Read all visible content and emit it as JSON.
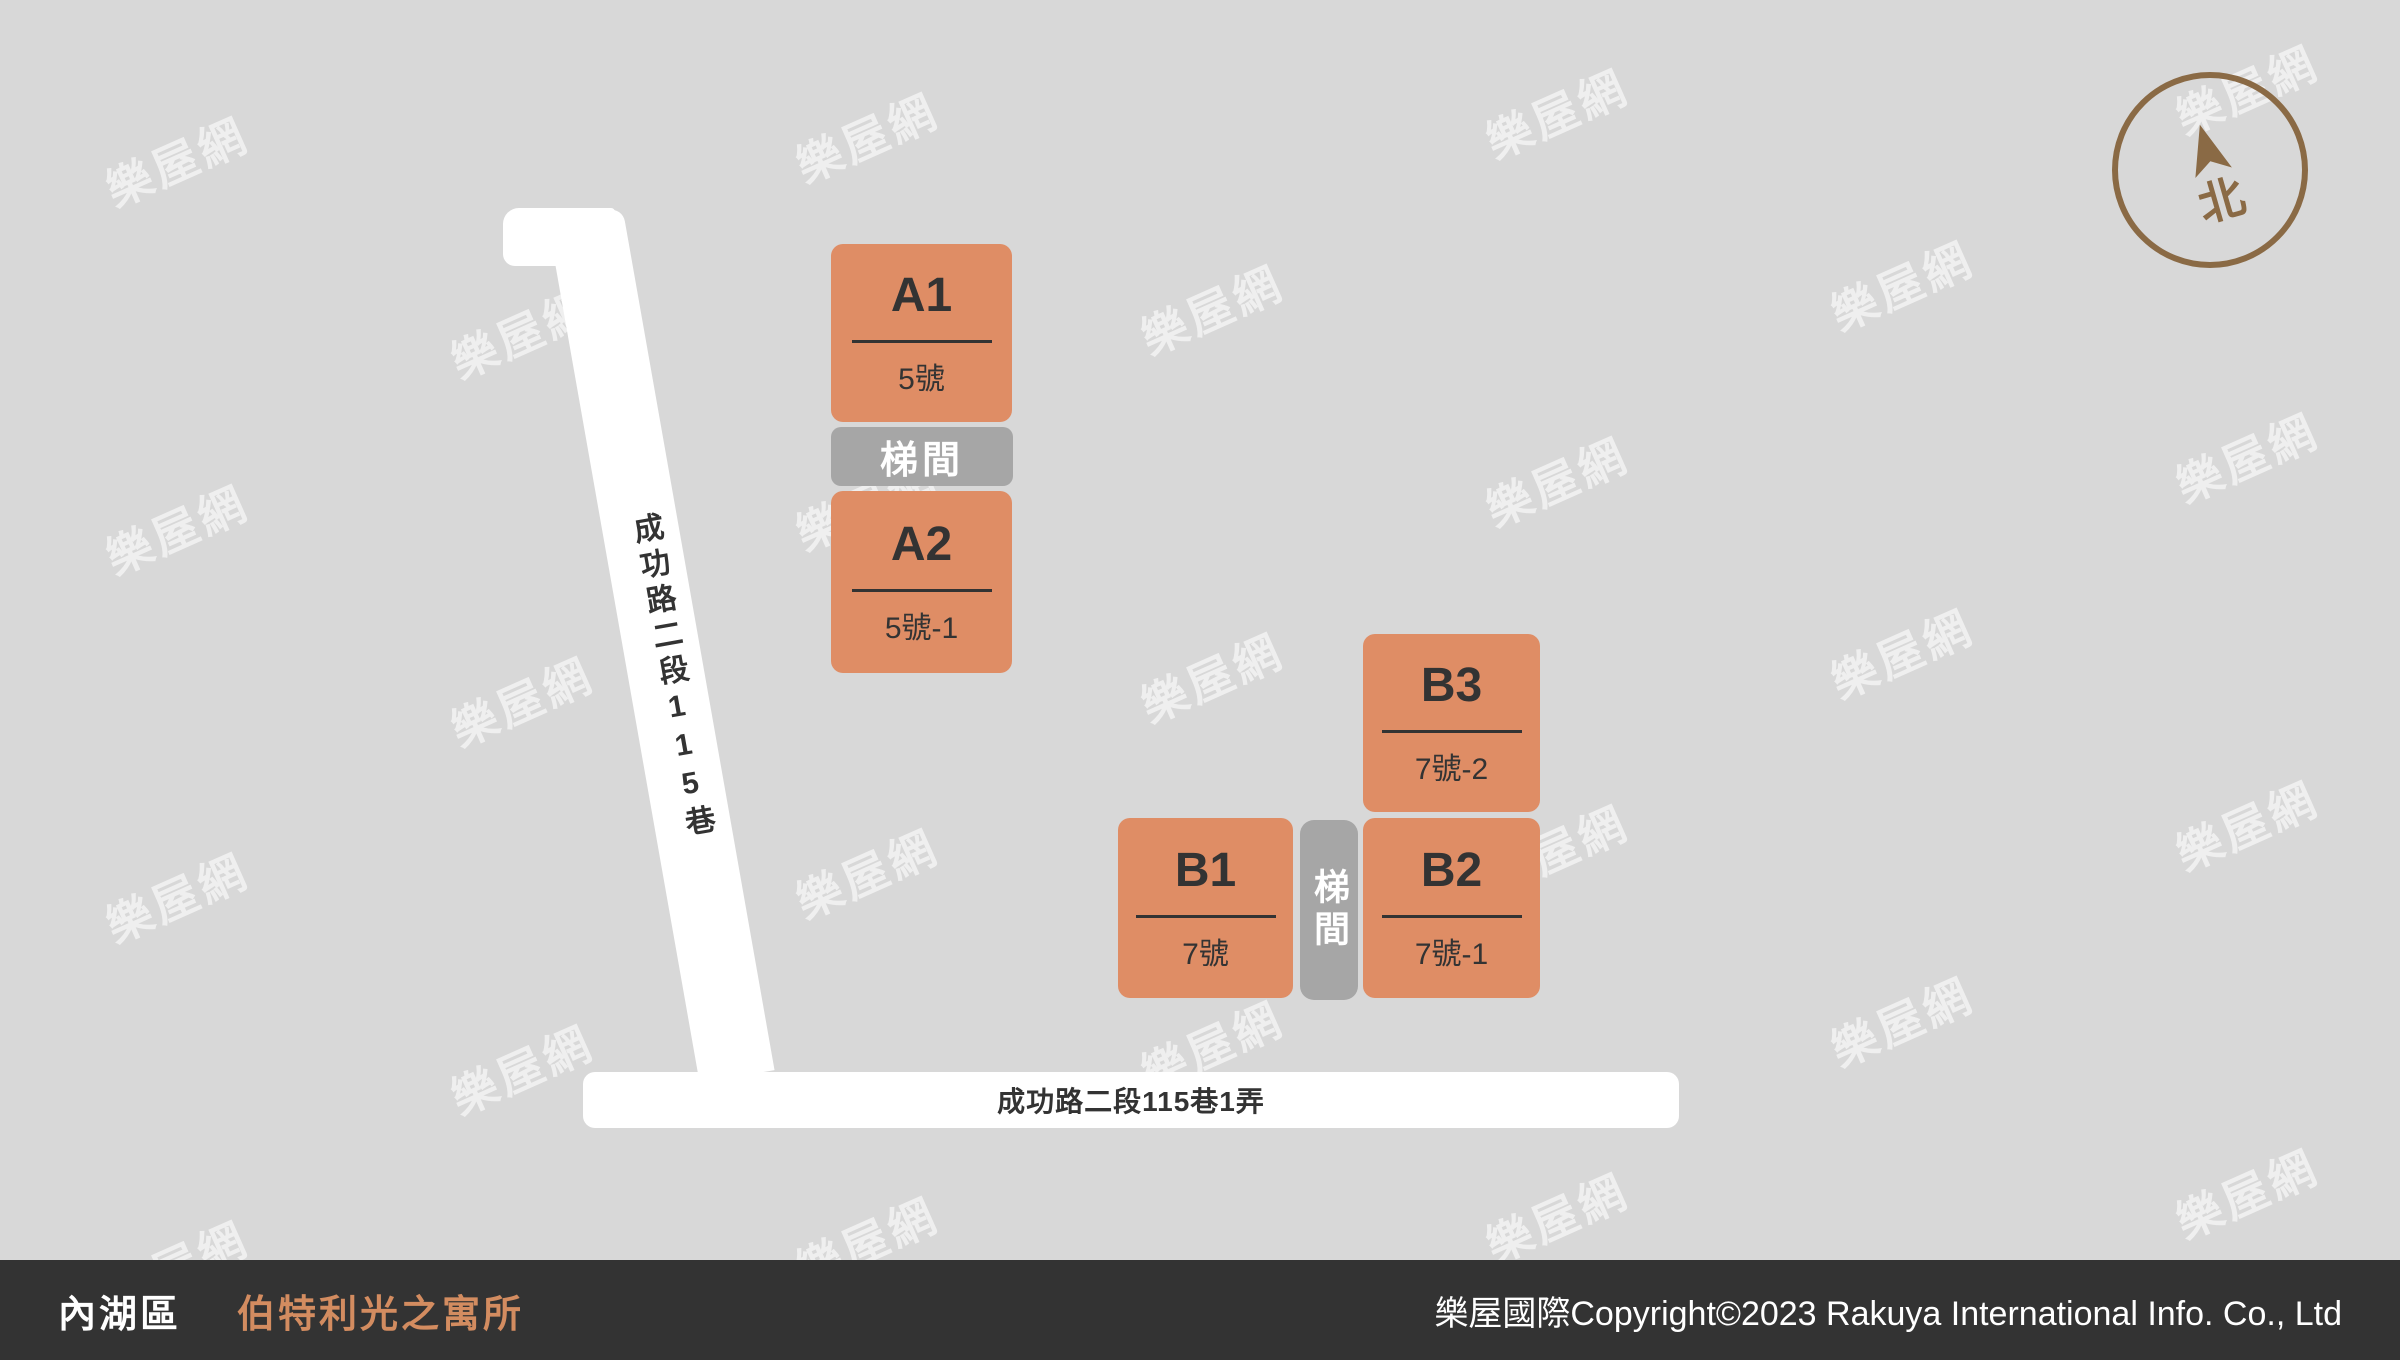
{
  "colors": {
    "bg": "#d8d8d8",
    "block": "#df8d65",
    "block_text": "#333333",
    "stair": "#a6a6a6",
    "road": "#ffffff",
    "footer_bg": "#333333",
    "footer_text": "#ffffff",
    "building_name": "#d38c60",
    "compass": "#8a6a45",
    "watermark": "rgba(255,255,255,0.6)"
  },
  "map": {
    "watermark": "樂屋網",
    "compass_label": "北",
    "stairwell_label": "梯間",
    "roads": {
      "vertical_label": "成功路二段115巷",
      "horizontal_label": "成功路二段115巷1弄"
    },
    "blocks": [
      {
        "unit": "A1",
        "address": "5號"
      },
      {
        "unit": "A2",
        "address": "5號-1"
      },
      {
        "unit": "B1",
        "address": "7號"
      },
      {
        "unit": "B2",
        "address": "7號-1"
      },
      {
        "unit": "B3",
        "address": "7號-2"
      }
    ]
  },
  "footer": {
    "district": "內湖區",
    "building": "伯特利光之寓所",
    "copyright": "樂屋國際Copyright©2023 Rakuya International Info. Co., Ltd"
  }
}
